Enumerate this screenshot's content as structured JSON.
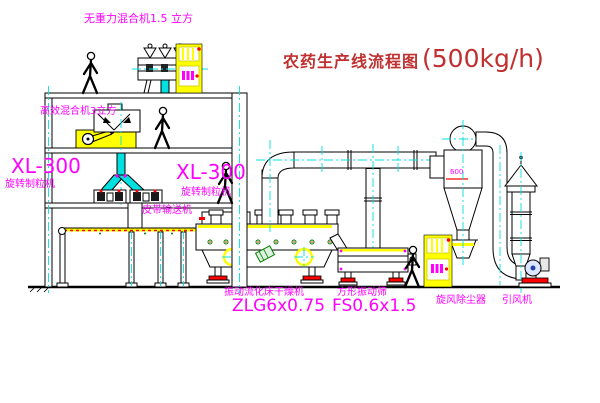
{
  "diagram": {
    "title": "农药生产线流程图",
    "capacity": "(500kg/h)"
  },
  "equipment_labels": {
    "gravity_mixer": "无重力混合机1.5 立方",
    "high_eff_mixer": "高效混合机3立方",
    "granulator_left_model": "XL-300",
    "granulator_left_name": "旋转制粒机",
    "granulator_right_model": "XL-300",
    "granulator_right_name": "旋转制粒机",
    "belt_conveyor": "皮带输送机",
    "fluid_bed_dryer_name": "振动流化床干燥机",
    "fluid_bed_dryer_model": "ZLG6x0.75",
    "square_sieve_name": "方形振动筛",
    "square_sieve_model": "FS0.6x1.5",
    "cyclone_name": "旋风除尘器",
    "cyclone_dim": "600",
    "fan_name": "引风机"
  },
  "colors": {
    "label_magenta": "#ff00ff",
    "title_red": "#c03030",
    "centerline_cyan": "#00e0e0",
    "cabinet_yellow": "#ffff00",
    "line_black": "#000000",
    "alert_red": "#ff0000",
    "motor_green": "#008000"
  }
}
